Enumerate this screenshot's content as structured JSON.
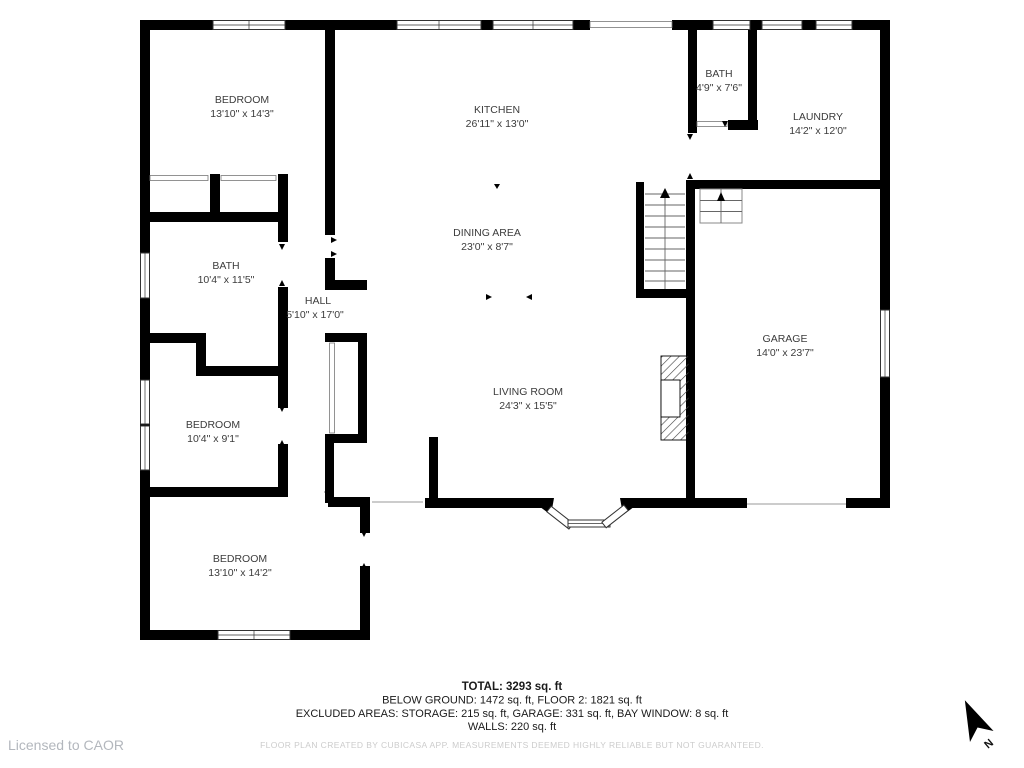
{
  "plan": {
    "rooms": {
      "bedroom_tl": {
        "name": "BEDROOM",
        "dims": "13'10\" x 14'3\""
      },
      "kitchen": {
        "name": "KITCHEN",
        "dims": "26'11\" x 13'0\""
      },
      "bath_upper": {
        "name": "BATH",
        "dims": "4'9\" x 7'6\""
      },
      "laundry": {
        "name": "LAUNDRY",
        "dims": "14'2\" x 12'0\""
      },
      "dining": {
        "name": "DINING AREA",
        "dims": "23'0\" x 8'7\""
      },
      "bath_main": {
        "name": "BATH",
        "dims": "10'4\" x 11'5\""
      },
      "hall": {
        "name": "HALL",
        "dims": "5'10\" x 17'0\""
      },
      "garage": {
        "name": "GARAGE",
        "dims": "14'0\" x 23'7\""
      },
      "bedroom_mid": {
        "name": "BEDROOM",
        "dims": "10'4\" x 9'1\""
      },
      "living": {
        "name": "LIVING ROOM",
        "dims": "24'3\" x 15'5\""
      },
      "bedroom_bottom": {
        "name": "BEDROOM",
        "dims": "13'10\" x 14'2\""
      }
    },
    "compass": {
      "label": "N",
      "icon": "north-arrow-icon"
    },
    "summary": {
      "total": "TOTAL: 3293 sq. ft",
      "areas_line": "BELOW GROUND: 1472 sq. ft, FLOOR 2: 1821 sq. ft",
      "excluded_line": "EXCLUDED AREAS: STORAGE: 215 sq. ft, GARAGE: 331 sq. ft, BAY WINDOW: 8 sq. ft",
      "walls_line": "WALLS: 220 sq. ft",
      "disclaimer": "FLOOR PLAN CREATED BY CUBICASA APP. MEASUREMENTS DEEMED HIGHLY RELIABLE BUT NOT GUARANTEED."
    },
    "license": "Licensed to CAOR",
    "colors": {
      "wall": "#000000",
      "label": "#3c3c3c",
      "summary_text": "#1a1a1a",
      "muted": "#cccccc",
      "license": "#b3b7bd"
    }
  }
}
